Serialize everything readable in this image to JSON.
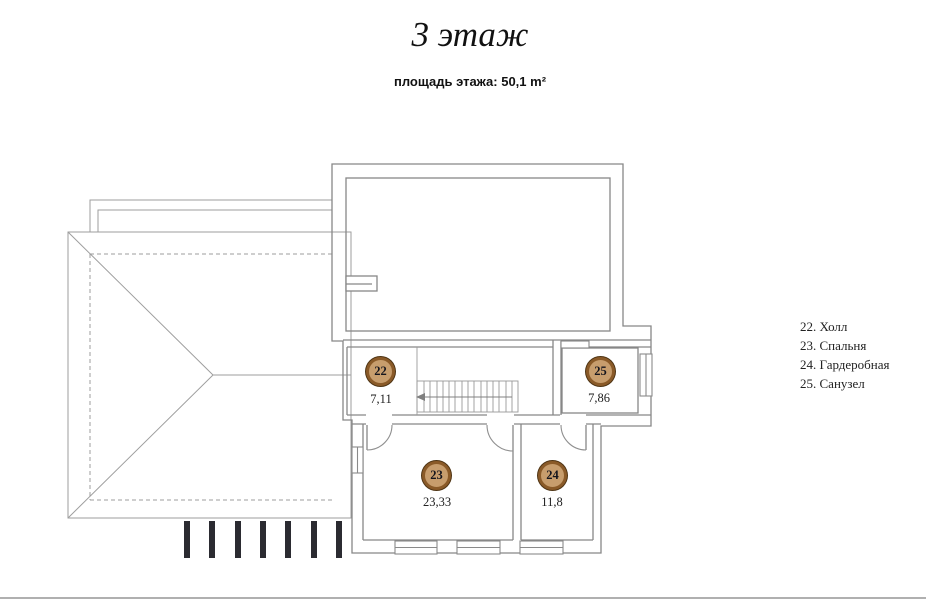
{
  "header": {
    "title": "3 этаж",
    "subtitle": "площадь этажа: 50,1 m²"
  },
  "legend": {
    "items": [
      "22. Холл",
      "23. Спальня",
      "24. Гардеробная",
      "25. Санузел"
    ]
  },
  "rooms": [
    {
      "number": "22",
      "name": "Холл",
      "area": "7,11"
    },
    {
      "number": "23",
      "name": "Спальня",
      "area": "23,33"
    },
    {
      "number": "24",
      "name": "Гардеробная",
      "area": "11,8"
    },
    {
      "number": "25",
      "name": "Санузел",
      "area": "7,86"
    }
  ],
  "colors": {
    "marker_fill": "#c79d6d",
    "marker_ring": "#8a5a28",
    "wall_line": "#878787",
    "beam_mark": "#2b2b31"
  }
}
